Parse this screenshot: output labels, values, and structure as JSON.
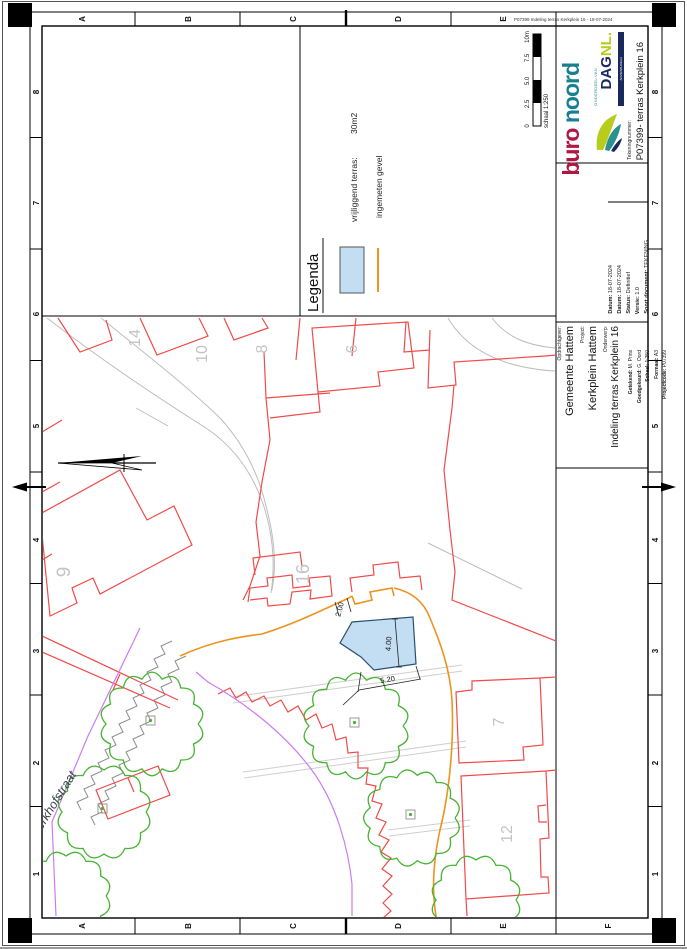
{
  "sheet": {
    "plot_stamp": "P07399 Indeling terras Kerkplein 16 - 18-07-2024",
    "grid": {
      "columns": [
        "A",
        "B",
        "C",
        "D",
        "E",
        "F"
      ],
      "rows": [
        "8",
        "7",
        "6",
        "5",
        "4",
        "3",
        "2",
        "1"
      ]
    },
    "scale_bar": {
      "labels": [
        "0",
        "2.5",
        "5.0",
        "7.5",
        "10m"
      ],
      "caption": "schaal 1:250"
    }
  },
  "legend": {
    "title": "Legenda",
    "items": [
      {
        "swatch": "blue-rect-swatch",
        "label": "vrijliggend terras:",
        "value": "30m2",
        "color": "#c3def2"
      },
      {
        "swatch": "orange-line-swatch",
        "label": "ingemeten gevel",
        "value": "",
        "color": "#ec9320"
      }
    ]
  },
  "map": {
    "street": "Kerkhofstraat",
    "parcel_numbers": [
      "9",
      "14",
      "10",
      "8",
      "6",
      "16",
      "7",
      "12"
    ],
    "dimensions": [
      "2.00",
      "4.00",
      "5.20"
    ],
    "terrace_fill": "#c3def2",
    "colors": {
      "cadastral_red": "#f04a4a",
      "measured_facade_orange": "#ec9320",
      "trees_green": "#46b332",
      "boundary_purple": "#cf7bf0",
      "roads_gray": "#bdbdbd"
    }
  },
  "title_block": {
    "logo_buro": {
      "part1": "buro ",
      "part2": "noord"
    },
    "logo_dag": {
      "pre": "ONDERDEEL VAN",
      "name_a": "DAG",
      "name_b": "NL.",
      "sub": "ADVIESBUREAU"
    },
    "tekeningnummer_label": "Tekeningnummer:",
    "tekeningnummer": "P07399- terras Kerkplein 16",
    "fields_meta": [
      {
        "label": "Datum:",
        "value": "18-07-2024"
      },
      {
        "label": "Datum:",
        "value": "18-07-2024"
      },
      {
        "label": "Status:",
        "value": "Definitief"
      },
      {
        "label": "Versie:",
        "value": "1.0"
      },
      {
        "label": "Soort document:",
        "value": "TEKENING"
      }
    ],
    "client": {
      "label": "Opdrachtgever:",
      "value": "Gemeente Hattem"
    },
    "project": {
      "label": "Project:",
      "value": "Kerkplein Hattem"
    },
    "subject": {
      "label": "Onderwerp:",
      "value": "Indeling terras Kerkplein 16"
    },
    "fields_drawing": [
      {
        "label": "Getekend:",
        "value": "M. Prins"
      },
      {
        "label": "Goedgekeurd:",
        "value": "G. Oord"
      },
      {
        "label": "Schaal:",
        "value": "1:250"
      },
      {
        "label": "Formaat:",
        "value": "A3"
      },
      {
        "label": "Projectcode:",
        "value": "P07399"
      }
    ]
  }
}
